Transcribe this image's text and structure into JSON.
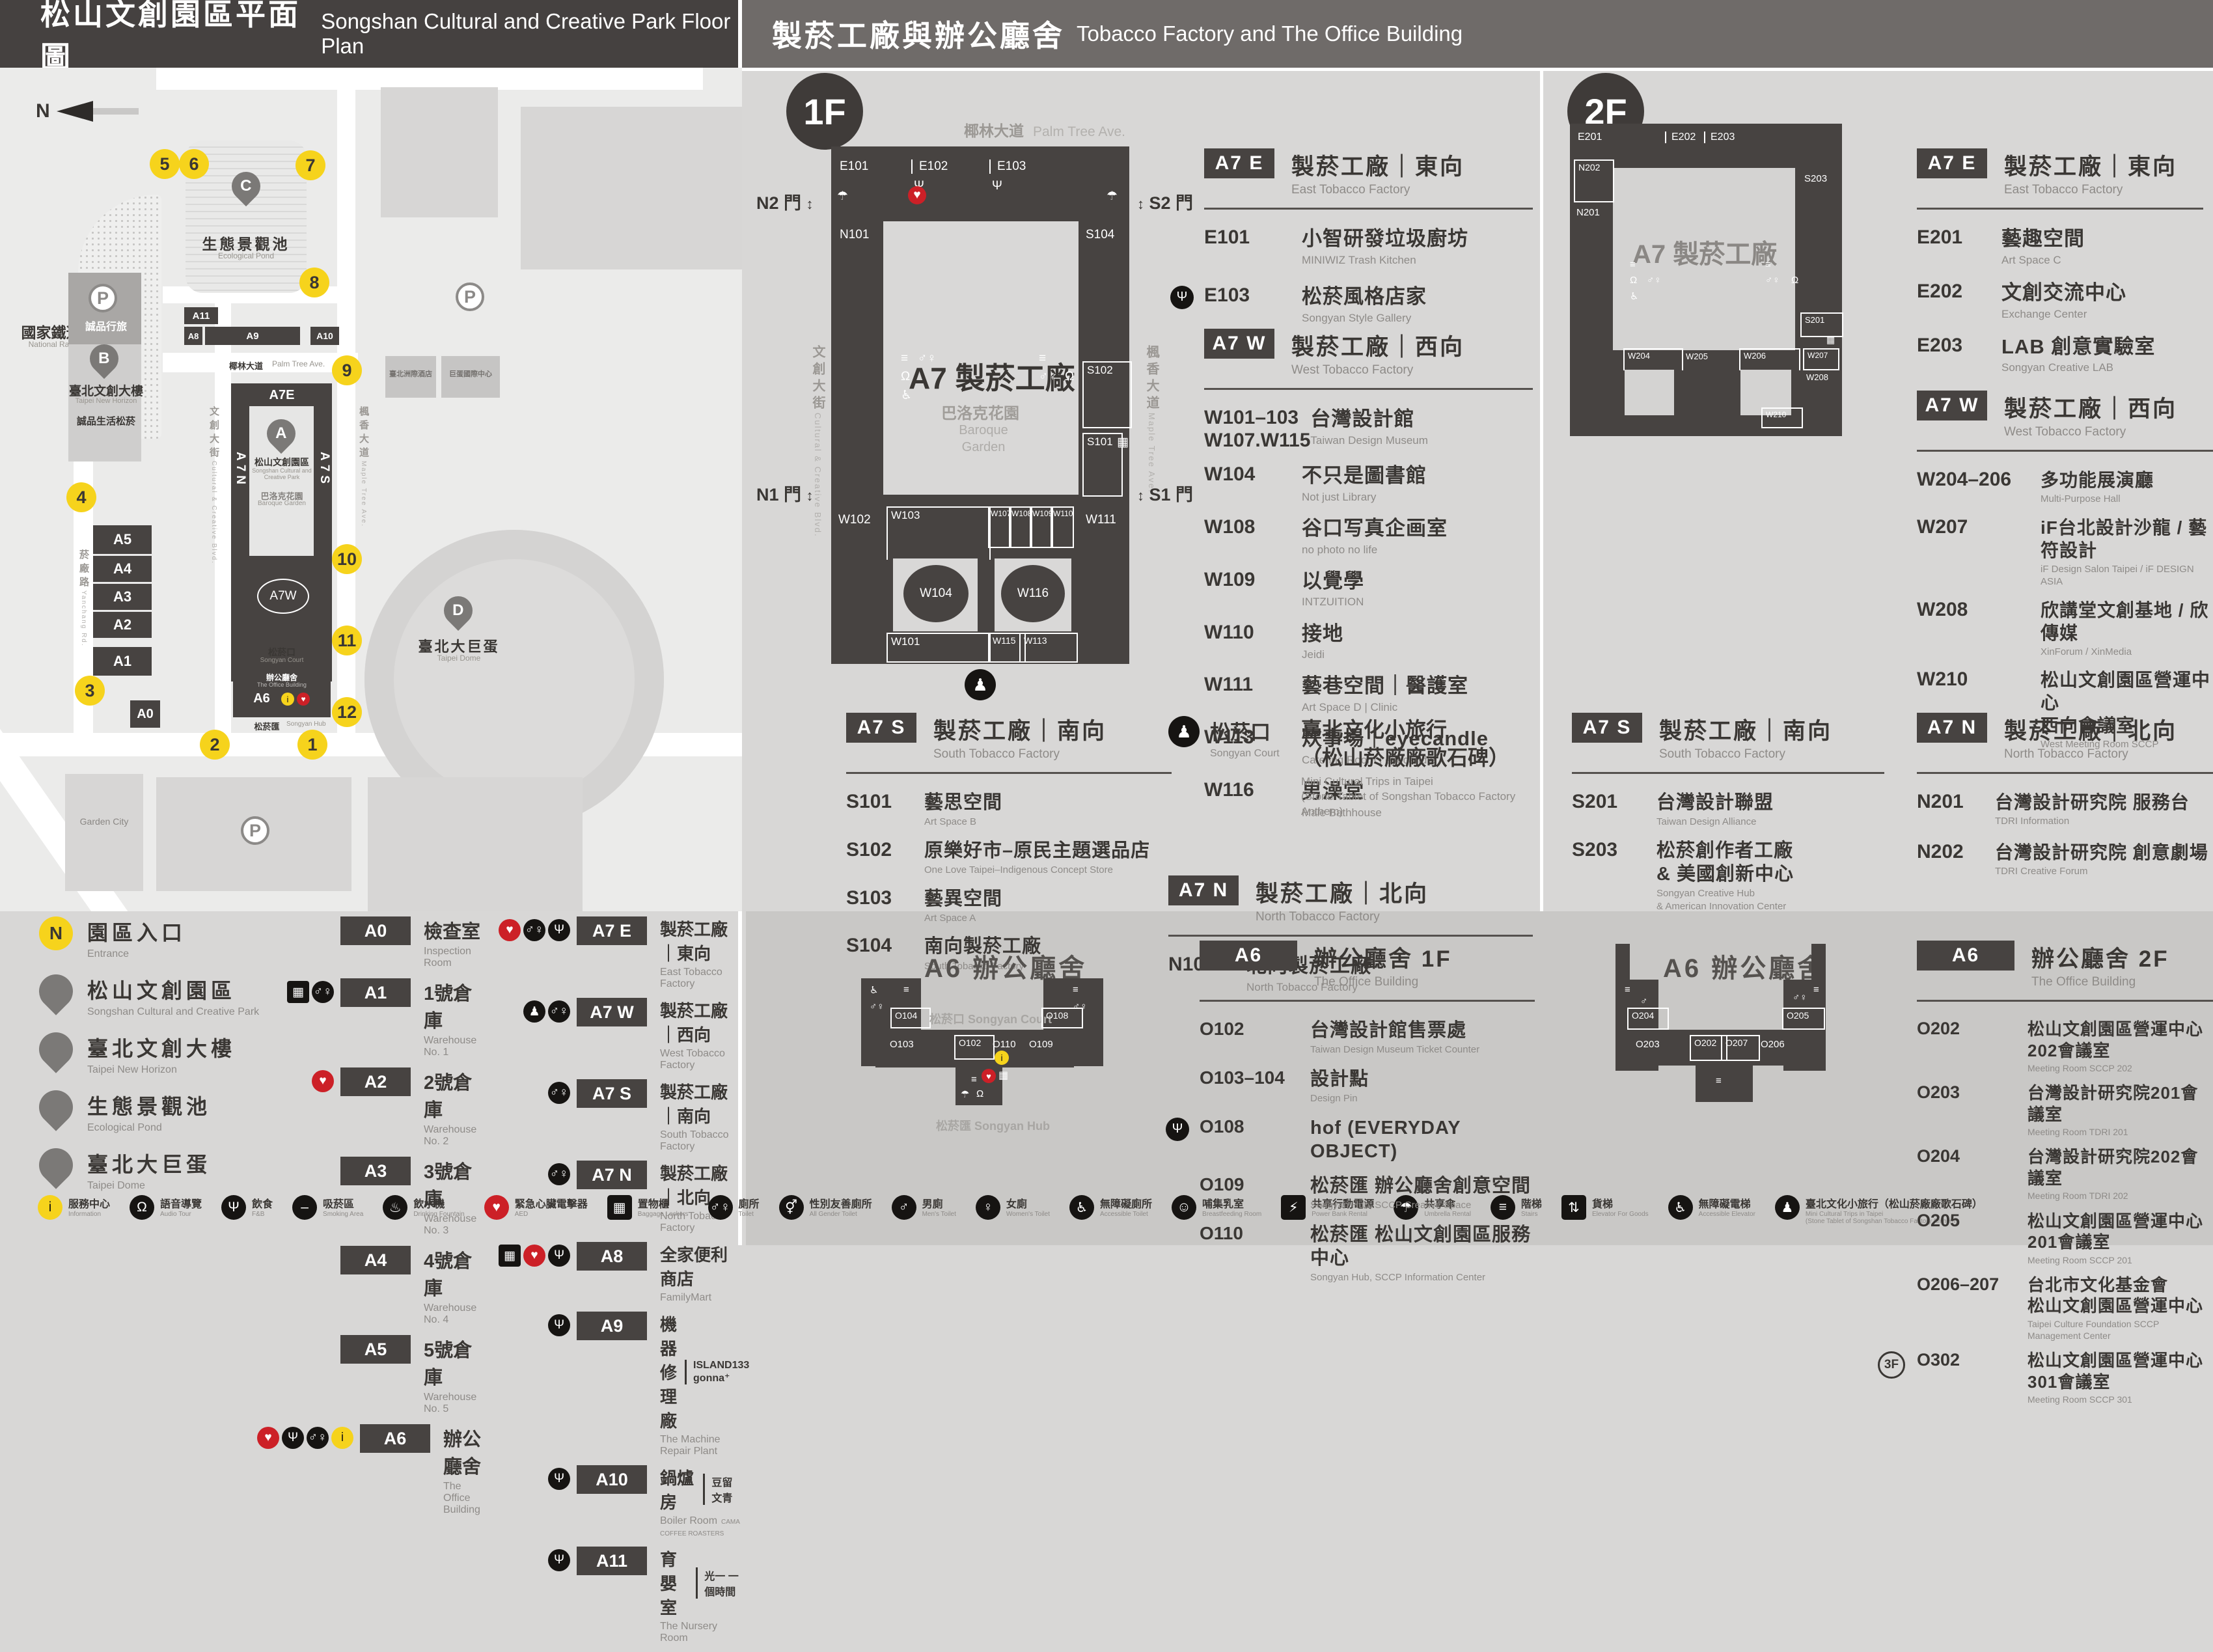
{
  "headers": {
    "left": {
      "zh": "松山文創園區平面圖",
      "en": "Songshan Cultural and Creative Park Floor Plan"
    },
    "right": {
      "zh": "製菸工廠與辦公廳舍",
      "en": "Tobacco Factory and The Office Building"
    }
  },
  "map": {
    "north": "N",
    "railway": {
      "zh": "國家鐵道博物館",
      "en": "National Railway Museum"
    },
    "pond": {
      "letter": "C",
      "zh": "生態景觀池",
      "en": "Ecological Pond"
    },
    "towerB": {
      "letter": "B",
      "zh": "臺北文創大樓",
      "en": "Taipei New Horizon"
    },
    "eslite_hotel": {
      "zh": "誠品行旅"
    },
    "eslite_mall": {
      "zh": "誠品生活松菸"
    },
    "parkA": {
      "letter": "A",
      "zh": "松山文創園區",
      "en": "Songshan Cultural and Creative Park"
    },
    "baroque": {
      "zh": "巴洛克花園",
      "en": "Baroque Garden"
    },
    "icc": {
      "zh": "臺北洲際酒店"
    },
    "domeintl": {
      "zh": "巨蛋國際中心"
    },
    "domeD": {
      "letter": "D",
      "zh": "臺北大巨蛋",
      "en": "Taipei Dome"
    },
    "court": {
      "zh": "松菸口",
      "en": "Songyan Court"
    },
    "office": {
      "zh": "辦公廳舍",
      "en": "The Office Building"
    },
    "hub": {
      "zh": "松菸匯",
      "en": "Songyan Hub"
    },
    "garden_city": {
      "en": "Garden City"
    },
    "roads": {
      "palm": {
        "zh": "椰林大道",
        "en": "Palm Tree Ave."
      },
      "ccblvd": {
        "zh": "文創大街",
        "en": "Cultural & Creative Blvd."
      },
      "maple": {
        "zh": "楓香大道",
        "en": "Maple Tree Ave."
      },
      "yanchang": {
        "zh": "菸廠路",
        "en": "Yanchang Rd."
      }
    },
    "blocks": {
      "a11": "A11",
      "a8": "A8",
      "a9": "A9",
      "a10": "A10",
      "a7e": "A7E",
      "a7w": "A7W",
      "a7n": "A7N",
      "a7s": "A7S",
      "a5": "A5",
      "a4": "A4",
      "a3": "A3",
      "a2": "A2",
      "a1": "A1",
      "a0": "A0",
      "a6": "A6"
    },
    "entrances": [
      "1",
      "2",
      "3",
      "4",
      "5",
      "6",
      "7",
      "8",
      "9",
      "10",
      "11",
      "12"
    ]
  },
  "legend": {
    "places": [
      {
        "letter": "N",
        "kind": "entrance",
        "zh": "園區入口",
        "en": "Entrance"
      },
      {
        "letter": "A",
        "kind": "place",
        "zh": "松山文創園區",
        "en": "Songshan Cultural and Creative Park"
      },
      {
        "letter": "B",
        "kind": "place",
        "zh": "臺北文創大樓",
        "en": "Taipei New Horizon"
      },
      {
        "letter": "C",
        "kind": "place",
        "zh": "生態景觀池",
        "en": "Ecological Pond"
      },
      {
        "letter": "D",
        "kind": "place",
        "zh": "臺北大巨蛋",
        "en": "Taipei Dome"
      }
    ],
    "buildings": [
      {
        "code": "A0",
        "zh": "檢查室",
        "en": "Inspection Room",
        "icons": []
      },
      {
        "code": "A1",
        "zh": "1號倉庫",
        "en": "Warehouse No. 1",
        "icons": [
          "locker",
          "toilet"
        ]
      },
      {
        "code": "A2",
        "zh": "2號倉庫",
        "en": "Warehouse No. 2",
        "icons": [
          "aed"
        ]
      },
      {
        "code": "A3",
        "zh": "3號倉庫",
        "en": "Warehouse No. 3",
        "icons": []
      },
      {
        "code": "A4",
        "zh": "4號倉庫",
        "en": "Warehouse No. 4",
        "icons": []
      },
      {
        "code": "A5",
        "zh": "5號倉庫",
        "en": "Warehouse No. 5",
        "icons": []
      },
      {
        "code": "A6",
        "zh": "辦公廳舍",
        "en": "The Office Building",
        "icons": [
          "aed",
          "dining",
          "toilet",
          "info"
        ]
      }
    ],
    "factory": [
      {
        "code": "A7 E",
        "zh": "製菸工廠｜東向",
        "en": "East Tobacco Factory",
        "icons": [
          "aed",
          "toilet",
          "dining"
        ]
      },
      {
        "code": "A7 W",
        "zh": "製菸工廠｜西向",
        "en": "West Tobacco Factory",
        "icons": [
          "culture",
          "toilet"
        ]
      },
      {
        "code": "A7 S",
        "zh": "製菸工廠｜南向",
        "en": "South Tobacco Factory",
        "icons": [
          "toilet"
        ]
      },
      {
        "code": "A7 N",
        "zh": "製菸工廠｜北向",
        "en": "North Tobacco Factory",
        "icons": [
          "toilet"
        ]
      },
      {
        "code": "A8",
        "zh": "全家便利商店",
        "en": "FamilyMart",
        "icons": [
          "locker",
          "aed",
          "dining"
        ]
      },
      {
        "code": "A9",
        "zh": "機器修理廠",
        "en": "The Machine Repair Plant",
        "icons": [
          "dining"
        ],
        "note": "ISLAND133 gonna⁺"
      },
      {
        "code": "A10",
        "zh": "鍋爐房",
        "en": "Boiler Room",
        "icons": [
          "dining"
        ],
        "note": "豆留文青",
        "note2": "CAMA COFFEE ROASTERS"
      },
      {
        "code": "A11",
        "zh": "育嬰室",
        "en": "The Nursery Room",
        "icons": [
          "dining"
        ],
        "note": "光一 一個時間"
      }
    ]
  },
  "facilities": [
    {
      "icon": "info",
      "zh": "服務中心",
      "en": "Information"
    },
    {
      "icon": "audio",
      "zh": "語音導覽",
      "en": "Audio Tour"
    },
    {
      "icon": "dining",
      "zh": "飲食",
      "en": "F&B"
    },
    {
      "icon": "smoking",
      "zh": "吸菸區",
      "en": "Smoking Area"
    },
    {
      "icon": "water",
      "zh": "飲水機",
      "en": "Drinking Fountain"
    },
    {
      "icon": "aed",
      "zh": "緊急心臟電擊器",
      "en": "AED"
    },
    {
      "icon": "locker",
      "zh": "置物櫃",
      "en": "Baggage Lockers"
    },
    {
      "icon": "toilet",
      "zh": "廁所",
      "en": "Toilet"
    },
    {
      "icon": "all-gender",
      "zh": "性別友善廁所",
      "en": "All Gender Toilet"
    },
    {
      "icon": "mens",
      "zh": "男廁",
      "en": "Men's Toilet"
    },
    {
      "icon": "womens",
      "zh": "女廁",
      "en": "Women's Toilet"
    },
    {
      "icon": "accessible",
      "zh": "無障礙廁所",
      "en": "Accessible Toilet"
    },
    {
      "icon": "nursing",
      "zh": "哺集乳室",
      "en": "Breastfeeding Room"
    },
    {
      "icon": "powerbank",
      "zh": "共享行動電源",
      "en": "Power Bank Rental"
    },
    {
      "icon": "umbrella",
      "zh": "共享傘",
      "en": "Umbrella Rental"
    },
    {
      "icon": "stairs",
      "zh": "階梯",
      "en": "Stairs"
    },
    {
      "icon": "goods",
      "zh": "貨梯",
      "en": "Elevator For Goods"
    },
    {
      "icon": "elevator",
      "zh": "無障礙電梯",
      "en": "Accessible Elevator"
    },
    {
      "icon": "culture",
      "zh": "臺北文化小旅行（松山菸廠廠歌石碑）",
      "en": "Mini Cultural Trips in Taipei",
      "en2": "(Stone Tablet of Songshan Tobacco Factory Anthem)"
    }
  ],
  "f1": {
    "badge": "1F",
    "street": {
      "zh": "椰林大道",
      "en": "Palm Tree Ave."
    },
    "plan": {
      "rooms": {
        "e101": "E101",
        "e102": "E102",
        "e103": "E103",
        "n101": "N101",
        "s104": "S104",
        "s102": "S102",
        "s101": "S101",
        "w102": "W102",
        "w103": "W103",
        "w104": "W104",
        "w107": "W107",
        "w108": "W108",
        "w109": "W109",
        "w110": "W110",
        "w111": "W111",
        "w116": "W116",
        "w101": "W101",
        "w115": "W115",
        "w113": "W113"
      },
      "gates": {
        "n2": "N2 門",
        "s2": "S2 門",
        "n1": "N1 門",
        "s1": "S1 門"
      },
      "center_zh": "A7 製菸工廠",
      "garden_zh": "巴洛克花園",
      "garden_en1": "Baroque",
      "garden_en2": "Garden",
      "side_left": {
        "zh": "文創大街",
        "en": "Cultural & Creative Blvd."
      },
      "side_right": {
        "zh": "楓香大道",
        "en": "Maple Tree Ave."
      }
    },
    "a7e": {
      "code": "A7 E",
      "zh": "製菸工廠｜東向",
      "en": "East Tobacco Factory",
      "rooms": [
        {
          "code": "E101",
          "zh": "小智研發垃圾廚坊",
          "en": "MINIWIZ Trash Kitchen"
        },
        {
          "code": "E103",
          "zh": "松菸風格店家",
          "en": "Songyan Style Gallery",
          "icon": "dining"
        }
      ]
    },
    "a7w": {
      "code": "A7 W",
      "zh": "製菸工廠｜西向",
      "en": "West Tobacco Factory",
      "rooms": [
        {
          "code": "W101–103",
          "code2": "W107.W115",
          "zh": "台灣設計館",
          "en": "Taiwan Design Museum"
        },
        {
          "code": "W104",
          "zh": "不只是圖書館",
          "en": "Not just Library"
        },
        {
          "code": "W108",
          "zh": "谷口写真企画室",
          "en": "no photo no life"
        },
        {
          "code": "W109",
          "zh": "以覺學",
          "en": "INTZUITION"
        },
        {
          "code": "W110",
          "zh": "接地",
          "en": "Jeidi"
        },
        {
          "code": "W111",
          "zh": "藝巷空間｜醫護室",
          "en": "Art Space D | Clinic"
        },
        {
          "code": "W113",
          "zh": "炊事場｜eyecandle",
          "en": "Catering Room | eyecandle"
        },
        {
          "code": "W116",
          "zh": "男澡堂",
          "en": "Male Bathhouse"
        }
      ]
    },
    "a7s": {
      "code": "A7 S",
      "zh": "製菸工廠｜南向",
      "en": "South Tobacco Factory",
      "rooms": [
        {
          "code": "S101",
          "zh": "藝思空間",
          "en": "Art Space B"
        },
        {
          "code": "S102",
          "zh": "原樂好市–原民主題選品店",
          "en": "One Love Taipei–Indigenous Concept Store"
        },
        {
          "code": "S103",
          "zh": "藝異空間",
          "en": "Art Space A"
        },
        {
          "code": "S104",
          "zh": "南向製菸工廠",
          "en": "South Tobacco Factory"
        }
      ]
    },
    "court": {
      "zh": "松菸口",
      "en": "Songyan Court",
      "title": "臺北文化小旅行",
      "title2": "（松山菸廠廠歌石碑）",
      "en1": "Mini Cultural Trips in Taipei",
      "en2": "(Stone Tablet of Songshan Tobacco Factory Anthem)"
    },
    "a7n": {
      "code": "A7 N",
      "zh": "製菸工廠｜北向",
      "en": "North Tobacco Factory",
      "rooms": [
        {
          "code": "N101",
          "zh": "北向製菸工廠",
          "en": "North Tobacco Factory"
        }
      ]
    },
    "a6": {
      "header": {
        "code": "A6",
        "zh": "辦公廳舍 1F",
        "en": "The Office Building"
      },
      "plan": {
        "title": "A6 辦公廳舍",
        "court_zh": "松菸口",
        "court_en": "Songyan Court",
        "hub_zh": "松菸匯",
        "hub_en": "Songyan Hub",
        "rooms": {
          "o104": "O104",
          "o103": "O103",
          "o102": "O102",
          "o110": "O110",
          "o109": "O109",
          "o108": "O108"
        }
      },
      "rooms": [
        {
          "code": "O102",
          "zh": "台灣設計館售票處",
          "en": "Taiwan Design Museum Ticket Counter"
        },
        {
          "code": "O103–104",
          "zh": "設計點",
          "en": "Design Pin"
        },
        {
          "code": "O108",
          "zh": "hof (EVERYDAY OBJECT)",
          "icon": "dining"
        },
        {
          "code": "O109",
          "zh": "松菸匯 辦公廳舍創意空間",
          "en": "Songyan Hub, SCCP Creative Space"
        },
        {
          "code": "O110",
          "zh": "松菸匯 松山文創園區服務中心",
          "en": "Songyan Hub, SCCP Information Center"
        }
      ]
    }
  },
  "f2": {
    "badge": "2F",
    "plan": {
      "rooms": {
        "e201": "E201",
        "e202": "E202",
        "e203": "E203",
        "n202": "N202",
        "n201": "N201",
        "s203": "S203",
        "s201": "S201",
        "w204": "W204",
        "w205": "W205",
        "w206": "W206",
        "w207": "W207",
        "w208": "W208",
        "w210": "W210"
      },
      "center_zh": "A7 製菸工廠"
    },
    "a7e": {
      "code": "A7 E",
      "zh": "製菸工廠｜東向",
      "en": "East Tobacco Factory",
      "rooms": [
        {
          "code": "E201",
          "zh": "藝趣空間",
          "en": "Art Space C"
        },
        {
          "code": "E202",
          "zh": "文創交流中心",
          "en": "Exchange Center"
        },
        {
          "code": "E203",
          "zh": "LAB 創意實驗室",
          "en": "Songyan Creative LAB"
        }
      ]
    },
    "a7w": {
      "code": "A7 W",
      "zh": "製菸工廠｜西向",
      "en": "West Tobacco Factory",
      "rooms": [
        {
          "code": "W204–206",
          "zh": "多功能展演廳",
          "en": "Multi-Purpose Hall"
        },
        {
          "code": "W207",
          "zh": "iF台北設計沙龍 / 藝符設計",
          "en": "iF Design Salon Taipei / iF DESIGN ASIA"
        },
        {
          "code": "W208",
          "zh": "欣講堂文創基地 / 欣傳媒",
          "en": "XinForum / XinMedia"
        },
        {
          "code": "W210",
          "zh": "松山文創園區營運中心",
          "zh2": "西向會議室",
          "en": "West Meeting Room SCCP"
        }
      ]
    },
    "a7s": {
      "code": "A7 S",
      "zh": "製菸工廠｜南向",
      "en": "South Tobacco Factory",
      "rooms": [
        {
          "code": "S201",
          "zh": "台灣設計聯盟",
          "en": "Taiwan Design Alliance"
        },
        {
          "code": "S203",
          "zh": "松菸創作者工廠",
          "zh2": "& 美國創新中心",
          "en": "Songyan Creative Hub",
          "en2": "& American Innovation Center"
        }
      ]
    },
    "a7n": {
      "code": "A7 N",
      "zh": "製菸工廠｜北向",
      "en": "North Tobacco Factory",
      "rooms": [
        {
          "code": "N201",
          "zh": "台灣設計研究院 服務台",
          "en": "TDRI Information"
        },
        {
          "code": "N202",
          "zh": "台灣設計研究院 創意劇場",
          "en": "TDRI Creative Forum"
        }
      ]
    },
    "a6": {
      "header": {
        "code": "A6",
        "zh": "辦公廳舍 2F",
        "en": "The Office Building"
      },
      "plan": {
        "title": "A6 辦公廳舍",
        "rooms": {
          "o204": "O204",
          "o205": "O205",
          "o203": "O203",
          "o202": "O202",
          "o207": "O207",
          "o206": "O206"
        }
      },
      "rooms": [
        {
          "code": "O202",
          "zh": "松山文創園區營運中心202會議室",
          "en": "Meeting Room SCCP 202"
        },
        {
          "code": "O203",
          "zh": "台灣設計研究院201會議室",
          "en": "Meeting Room TDRI 201"
        },
        {
          "code": "O204",
          "zh": "台灣設計研究院202會議室",
          "en": "Meeting Room TDRI 202"
        },
        {
          "code": "O205",
          "zh": "松山文創園區營運中心201會議室",
          "en": "Meeting Room SCCP 201"
        },
        {
          "code": "O206–207",
          "zh": "台北市文化基金會",
          "zh2": "松山文創園區營運中心",
          "en": "Taipei Culture Foundation SCCP Management Center"
        },
        {
          "code": "O302",
          "pre": "3F",
          "zh": "松山文創園區營運中心301會議室",
          "en": "Meeting Room SCCP 301"
        }
      ]
    }
  }
}
